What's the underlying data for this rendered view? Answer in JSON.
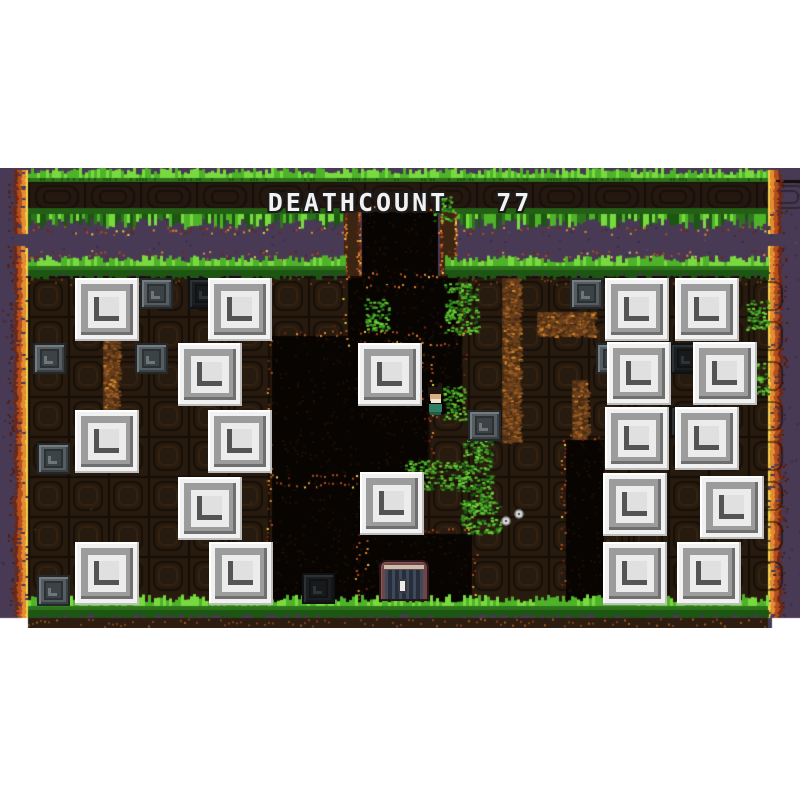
{
  "hud": {
    "label": "DEATHCOUNT",
    "value": "77"
  },
  "scene": {
    "viewport": {
      "left": 0,
      "top": 168,
      "width": 800,
      "height": 460
    },
    "palette": {
      "white_bg": "#ffffff",
      "purple_bg": "#483a54",
      "purple_dot": "#3b2d46",
      "purple_dot_light": "#584768",
      "ember": [
        "#f6d049",
        "#ea8b2e",
        "#b54d1b",
        "#6f2713"
      ],
      "dirt_base": "#271a0e",
      "dirt_seam": "#150d08",
      "band_base": "#241810",
      "cave": "#080402",
      "grass_bright": "#79da3f",
      "grass_mid": "#4fb32a",
      "grass_base": "#2c731b",
      "grass_dark": "#1d5512",
      "wall_fill": "#3b2512",
      "vein_dark": "#4a2d14",
      "vein_mid": "#6b401c",
      "vein_light": "#9c5c22",
      "vein_bright": "#d4882c",
      "floor_dirt": "#2d1c10",
      "floor_dot": "#7a441c"
    },
    "band": {
      "x": 28,
      "width": 740,
      "grass_top": 170,
      "tile_top": 180,
      "tile_bottom": 212,
      "hang_bottom": 228,
      "tile_w": 56
    },
    "tube": {
      "interior": [
        362,
        212,
        76,
        70
      ],
      "left_wall": [
        344,
        212,
        16,
        70
      ],
      "right_wall": [
        440,
        212,
        16,
        70
      ]
    },
    "field": {
      "x": 28,
      "width": 740,
      "fringe_top": 250,
      "grass_y": 262,
      "dirt_top": 276,
      "dirt_bottom": 602,
      "floor_grass_y": 602,
      "bottom": 628,
      "tile": 40
    },
    "grass_gap": [
      344,
      445
    ],
    "cave_rects": [
      [
        362,
        212,
        76,
        70
      ],
      [
        348,
        278,
        110,
        62
      ],
      [
        272,
        336,
        156,
        146
      ],
      [
        424,
        330,
        38,
        84
      ],
      [
        272,
        480,
        92,
        122
      ],
      [
        360,
        534,
        112,
        68
      ],
      [
        566,
        440,
        38,
        162
      ]
    ],
    "veins": [
      [
        103,
        278,
        16,
        172
      ],
      [
        502,
        278,
        18,
        164
      ],
      [
        572,
        380,
        16,
        70
      ],
      [
        389,
        408,
        12,
        70
      ],
      [
        537,
        312,
        58,
        24
      ]
    ],
    "vines": [
      [
        444,
        282,
        34,
        52
      ],
      [
        364,
        298,
        24,
        32
      ],
      [
        443,
        386,
        22,
        34
      ],
      [
        402,
        460,
        64,
        30
      ],
      [
        462,
        440,
        30,
        72
      ],
      [
        460,
        500,
        40,
        34
      ],
      [
        746,
        300,
        22,
        30
      ],
      [
        746,
        360,
        22,
        34
      ],
      [
        433,
        196,
        20,
        24
      ]
    ],
    "flowers": [
      [
        506,
        521
      ],
      [
        519,
        514
      ]
    ],
    "white_blocks": [
      [
        75,
        278
      ],
      [
        208,
        278
      ],
      [
        178,
        343
      ],
      [
        75,
        410
      ],
      [
        208,
        410
      ],
      [
        178,
        477
      ],
      [
        75,
        542
      ],
      [
        209,
        542
      ],
      [
        358,
        343
      ],
      [
        360,
        472
      ],
      [
        605,
        278
      ],
      [
        675,
        278
      ],
      [
        607,
        342
      ],
      [
        693,
        342
      ],
      [
        605,
        407
      ],
      [
        675,
        407
      ],
      [
        603,
        473
      ],
      [
        700,
        476
      ],
      [
        603,
        542
      ],
      [
        677,
        542
      ]
    ],
    "stone_blocks": [
      {
        "x": 140,
        "y": 278,
        "v": "gray"
      },
      {
        "x": 570,
        "y": 278,
        "v": "gray"
      },
      {
        "x": 33,
        "y": 343,
        "v": "gray"
      },
      {
        "x": 135,
        "y": 343,
        "v": "gray"
      },
      {
        "x": 468,
        "y": 410,
        "v": "gray"
      },
      {
        "x": 37,
        "y": 443,
        "v": "gray"
      },
      {
        "x": 37,
        "y": 575,
        "v": "gray"
      },
      {
        "x": 302,
        "y": 573,
        "v": "dark"
      },
      {
        "x": 188,
        "y": 278,
        "v": "dark"
      },
      {
        "x": 596,
        "y": 343,
        "v": "gray"
      },
      {
        "x": 670,
        "y": 343,
        "v": "dark"
      },
      {
        "x": 670,
        "y": 406,
        "v": "dark"
      }
    ],
    "player": {
      "x": 427,
      "y": 387,
      "width": 17,
      "height": 28
    },
    "door": {
      "x": 379,
      "y": 560,
      "width": 50,
      "height": 41
    }
  }
}
